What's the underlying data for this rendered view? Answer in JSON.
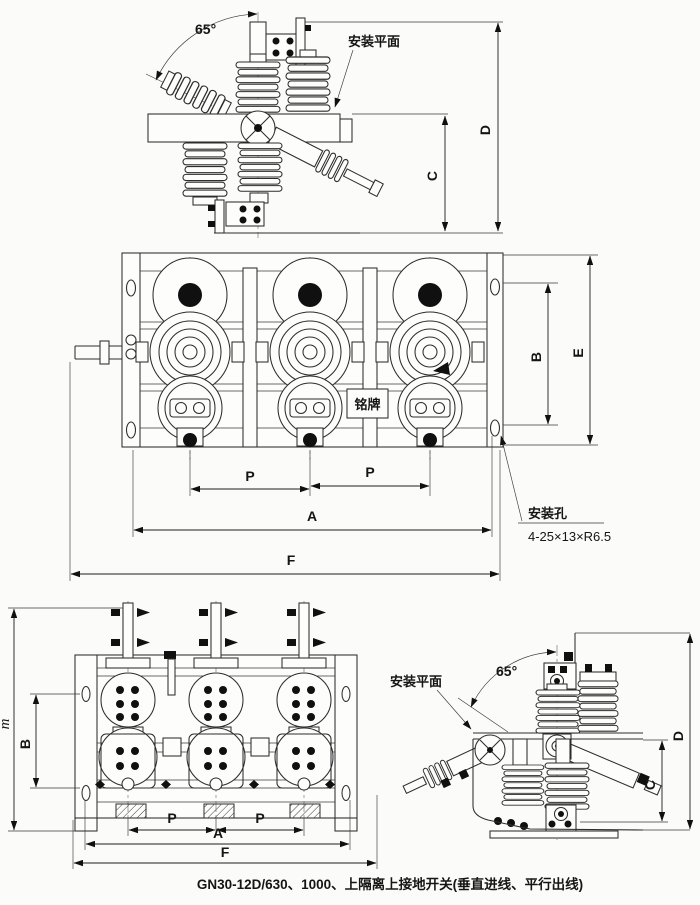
{
  "caption": "GN30-12D/630、1000、上隔离上接地开关(垂直进线、平行出线)",
  "side_view_top": {
    "angle": "65°",
    "mounting_plane": "安装平面",
    "dim_c": "C",
    "dim_d": "D"
  },
  "plan_view": {
    "nameplate": "铭牌",
    "dim_b": "B",
    "dim_e": "E",
    "dim_p1": "P",
    "dim_p2": "P",
    "dim_a": "A",
    "dim_f": "F",
    "hole_label": "安装孔",
    "hole_spec": "4-25×13×R6.5"
  },
  "front_view": {
    "dim_m": "m",
    "dim_b": "B",
    "dim_p1": "P",
    "dim_p2": "P",
    "dim_a": "A",
    "dim_f": "F"
  },
  "side_view_bottom": {
    "angle": "65°",
    "mounting_plane": "安装平面",
    "dim_c": "C",
    "dim_d": "D"
  }
}
